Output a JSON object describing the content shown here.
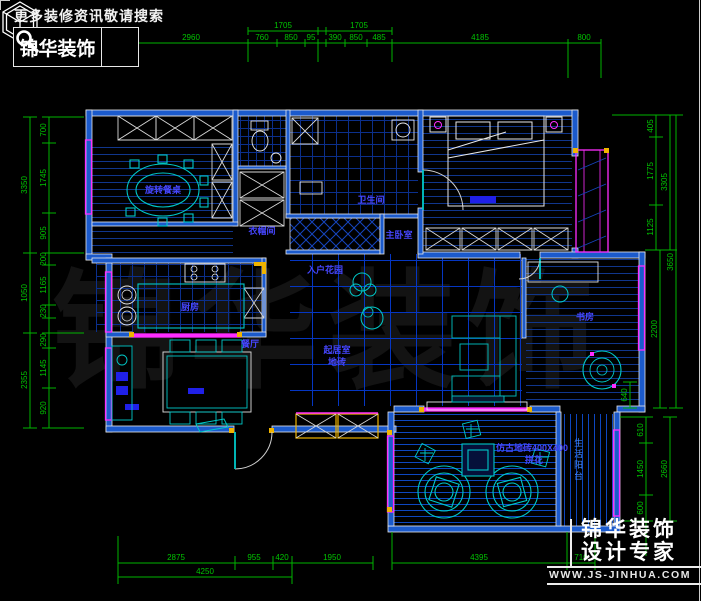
{
  "header": {
    "tagline": "更多装修资讯敬请搜索",
    "brand": "锦华装饰"
  },
  "watermark": {
    "text": "锦华装饰"
  },
  "branding": {
    "line1": "锦华装饰",
    "line2": "设计专家",
    "url": "WWW.JS-JINHUA.COM"
  },
  "colors": {
    "background": "#000000",
    "dimension_green": "#00c400",
    "wall_blue": "#1b5acc",
    "wall_edge_white": "#e8e8e8",
    "window_magenta": "#ff2dff",
    "furniture_cyan": "#00c8c8",
    "label_blue": "#4646ff",
    "accent_yellow": "#f0b400"
  },
  "dims": {
    "top": [
      "2960",
      "1705",
      "1705",
      "760",
      "850",
      "95",
      "390",
      "850",
      "485",
      "4185",
      "800"
    ],
    "left_outer": [
      "3350",
      "1050",
      "2355"
    ],
    "left_inner": [
      "700",
      "1745",
      "905",
      "200",
      "1165",
      "230",
      "290",
      "1145",
      "920"
    ],
    "right": [
      "405",
      "1775",
      "1125",
      "3305",
      "640",
      "2200",
      "3650"
    ],
    "right_lower": [
      "610",
      "1450",
      "600",
      "2660"
    ],
    "bottom": [
      "2875",
      "955",
      "420",
      "1950",
      "4395",
      "710",
      "4250"
    ]
  },
  "labels": {
    "dining_table": "旋转餐桌",
    "cloakroom": "衣帽间",
    "bathroom": "卫生间",
    "master_bedroom": "主卧室",
    "kitchen": "厨房",
    "foyer": "入户花园",
    "living": "起居室",
    "living_floor": "地砖",
    "dining": "餐厅",
    "study": "书房",
    "balcony_floor": "仿古地砖400X400",
    "balcony_pattern": "拼花",
    "side_balcony": "生活阳台"
  }
}
